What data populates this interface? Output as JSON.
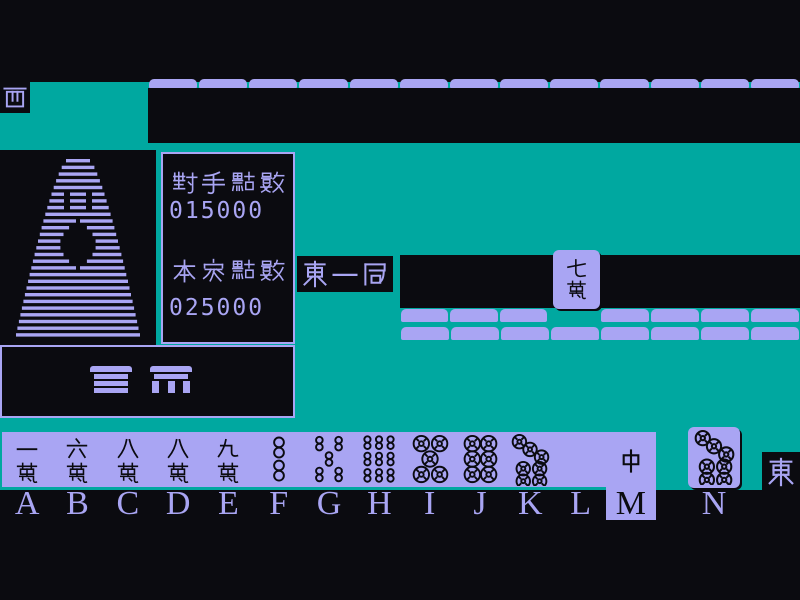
{
  "colors": {
    "teal": "#00a8a0",
    "lavender": "#a9a5f3",
    "ink": "#0b0b10"
  },
  "seats": {
    "opponent_wind": "西",
    "player_wind": "東"
  },
  "round": {
    "label": "東一局"
  },
  "scores": {
    "opponent_label": "對手點數",
    "opponent_value": "015000",
    "player_label": "本家點數",
    "player_value": "025000"
  },
  "opponent": {
    "hand_back_count": 13,
    "claimed_tile": {
      "code": "7m",
      "label": "七萬"
    }
  },
  "wall": {
    "row1_left_count": 3,
    "row1_right_count": 4,
    "row2_count": 8
  },
  "decor": {
    "tower": "tile-pagoda",
    "tray_icons": [
      "tile-stack",
      "tile-bench"
    ]
  },
  "hand": {
    "selected_key": "M",
    "slots": [
      {
        "key": "A",
        "code": "1m",
        "label": "一萬"
      },
      {
        "key": "B",
        "code": "6m",
        "label": "六萬"
      },
      {
        "key": "C",
        "code": "8m",
        "label": "八萬"
      },
      {
        "key": "D",
        "code": "8m",
        "label": "八萬"
      },
      {
        "key": "E",
        "code": "9m",
        "label": "九萬"
      },
      {
        "key": "F",
        "code": "2s",
        "label": "二索"
      },
      {
        "key": "G",
        "code": "5s",
        "label": "五索"
      },
      {
        "key": "H",
        "code": "9s",
        "label": "九索"
      },
      {
        "key": "I",
        "code": "5p",
        "label": "五筒"
      },
      {
        "key": "J",
        "code": "6p",
        "label": "六筒"
      },
      {
        "key": "K",
        "code": "7p",
        "label": "七筒"
      },
      {
        "key": "L",
        "code": "haku",
        "label": "白"
      },
      {
        "key": "M",
        "code": "chun",
        "label": "中"
      }
    ],
    "drawn": {
      "key": "N",
      "code": "7p",
      "label": "七筒"
    }
  }
}
